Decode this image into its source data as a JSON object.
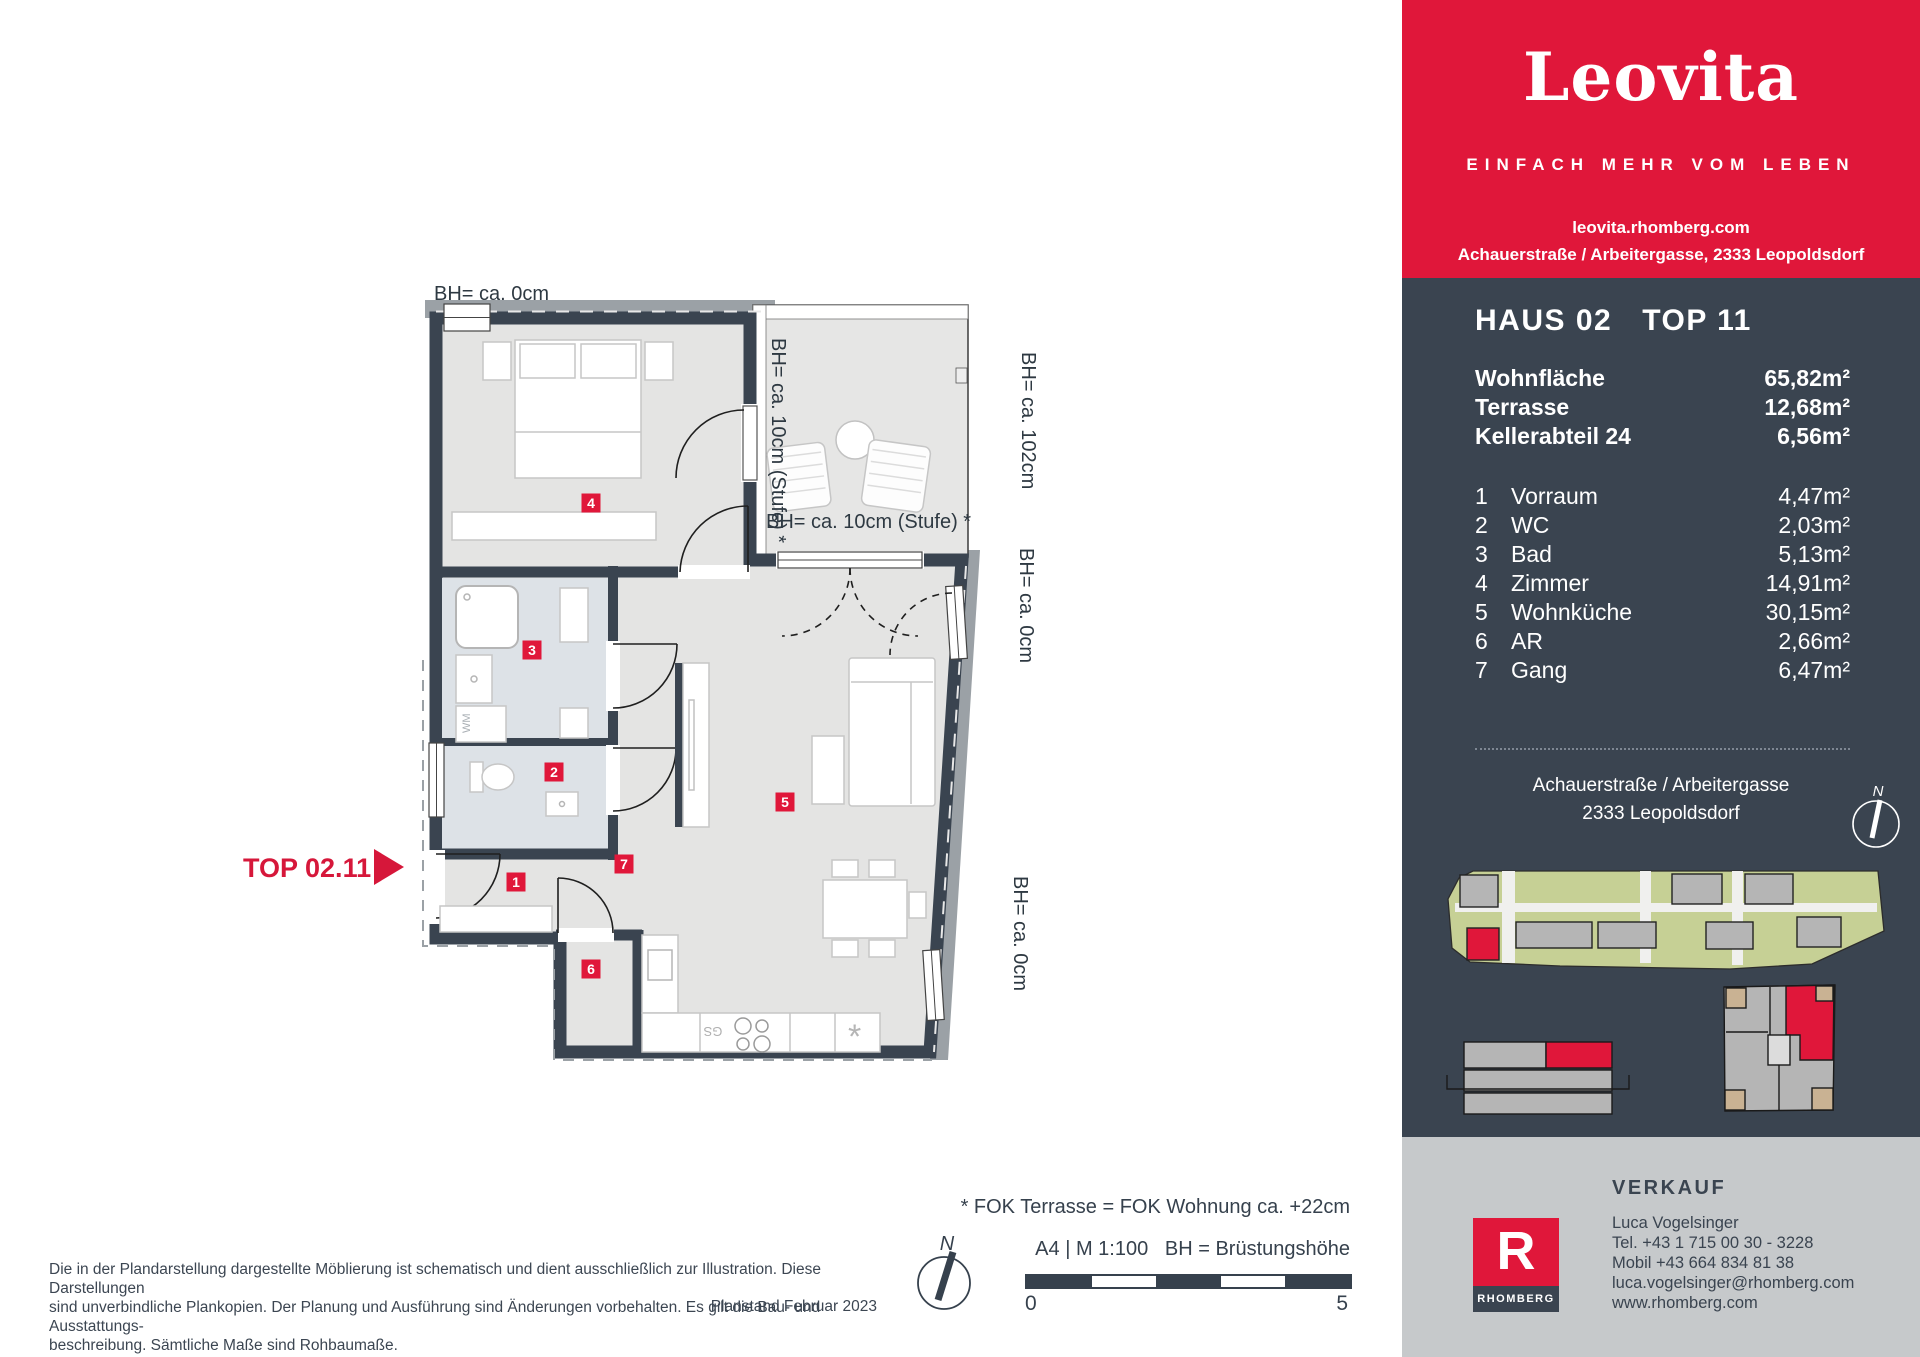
{
  "brand": {
    "logo_text": "Leovita",
    "tagline": "EINFACH MEHR VOM LEBEN",
    "website": "leovita.rhomberg.com",
    "address_line": "Achauerstraße / Arbeitergasse, 2333 Leopoldsdorf",
    "colors": {
      "red": "#e0173a",
      "slate": "#3a4450",
      "footer_gray": "#c6c9cb"
    }
  },
  "unit": {
    "title_house": "HAUS 02",
    "title_top": "TOP 11",
    "areas": [
      {
        "label": "Wohnfläche",
        "value": "65,82m²"
      },
      {
        "label": "Terrasse",
        "value": "12,68m²"
      },
      {
        "label": "Kellerabteil 24",
        "value": "6,56m²"
      }
    ],
    "rooms": [
      {
        "no": "1",
        "name": "Vorraum",
        "area": "4,47m²"
      },
      {
        "no": "2",
        "name": "WC",
        "area": "2,03m²"
      },
      {
        "no": "3",
        "name": "Bad",
        "area": "5,13m²"
      },
      {
        "no": "4",
        "name": "Zimmer",
        "area": "14,91m²"
      },
      {
        "no": "5",
        "name": "Wohnküche",
        "area": "30,15m²"
      },
      {
        "no": "6",
        "name": "AR",
        "area": "2,66m²"
      },
      {
        "no": "7",
        "name": "Gang",
        "area": "6,47m²"
      }
    ],
    "address": [
      "Achauerstraße / Arbeitergasse",
      "2333 Leopoldsdorf"
    ],
    "compass": "N"
  },
  "plan": {
    "top_label": "TOP 02.11",
    "bh_labels": {
      "top": "BH= ca. 0cm",
      "terrace_left": "BH= ca. 10cm (Stufe) *",
      "terrace_right": "BH= ca. 102cm",
      "terrace_bottom": "BH= ca. 10cm (Stufe) *",
      "living_door": "BH= ca. 0cm",
      "kitchen_window": "BH= ca. 0cm"
    },
    "badges": [
      "1",
      "2",
      "3",
      "4",
      "5",
      "6",
      "7"
    ],
    "appliances": {
      "wm": "WM",
      "gs": "GS",
      "sink": "*"
    }
  },
  "legend": {
    "fok_note": "* FOK Terrasse = FOK Wohnung ca. +22cm",
    "format_scale": "A4 | M 1:100   BH = Brüstungshöhe",
    "scale_start": "0",
    "scale_end": "5",
    "compass": "N"
  },
  "disclaimer": {
    "line1": "Die in der Plandarstellung dargestellte Möblierung ist schematisch und dient ausschließlich zur Illustration. Diese Darstellungen",
    "line2": "sind unverbindliche Plankopien. Der Planung und Ausführung sind Änderungen vorbehalten. Es gilt die Bau- und Ausstattungs-",
    "line3": "beschreibung. Sämtliche Maße sind Rohbaumaße.",
    "planstand": "Planstand Februar 2023"
  },
  "verkauf": {
    "heading": "VERKAUF",
    "name": "Luca Vogelsinger",
    "tel": "Tel. +43 1 715 00 30 - 3228",
    "mobile": "Mobil +43 664 834 81 38",
    "email": "luca.vogelsinger@rhomberg.com",
    "web": "www.rhomberg.com",
    "logo_letter": "R",
    "logo_text": "RHOMBERG"
  }
}
